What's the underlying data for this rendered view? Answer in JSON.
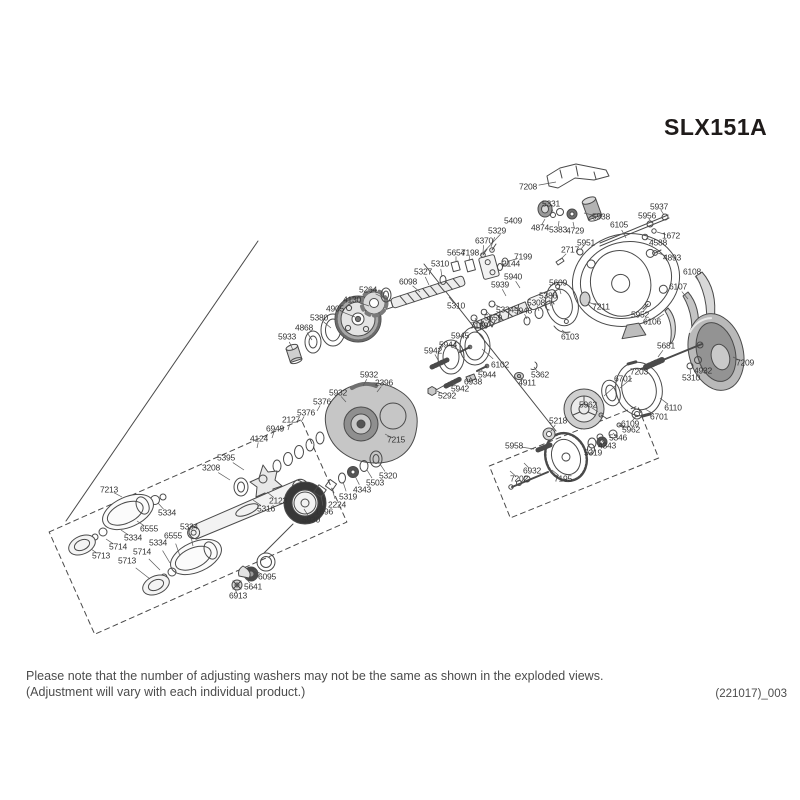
{
  "title": "SLX151A",
  "footer": {
    "line1": "Please note that the number of adjusting washers may not be the same as shown in the exploded views.",
    "line2": "(Adjustment will vary with each individual product.)"
  },
  "doc_code": "(221017)_003",
  "colors": {
    "line": "#4a4a4a",
    "label_text": "#333333",
    "title_text": "#1f1b1a",
    "footer_text": "#4c4c4c",
    "shade_light": "#d8d8d8",
    "shade_mid": "#a8a8a8",
    "shade_dark": "#383838"
  },
  "diagram": {
    "description": "Exploded parts view of SLX151A baitcasting reel",
    "labels": [
      {
        "n": "7208",
        "x": 528,
        "y": 187,
        "lx": 556,
        "ly": 182
      },
      {
        "n": "5331",
        "x": 551,
        "y": 204,
        "lx": 553,
        "ly": 212
      },
      {
        "n": "5938",
        "x": 601,
        "y": 217,
        "lx": 584,
        "ly": 213
      },
      {
        "n": "4874",
        "x": 540,
        "y": 228,
        "lx": 545,
        "ly": 219
      },
      {
        "n": "5383",
        "x": 558,
        "y": 230,
        "lx": 559,
        "ly": 221
      },
      {
        "n": "4729",
        "x": 575,
        "y": 231,
        "lx": 573,
        "ly": 222
      },
      {
        "n": "6105",
        "x": 619,
        "y": 225,
        "lx": 626,
        "ly": 238
      },
      {
        "n": "5956",
        "x": 647,
        "y": 216,
        "lx": 652,
        "ly": 223
      },
      {
        "n": "5937",
        "x": 659,
        "y": 207,
        "lx": 664,
        "ly": 215
      },
      {
        "n": "1672",
        "x": 671,
        "y": 236,
        "lx": 657,
        "ly": 232
      },
      {
        "n": "4588",
        "x": 658,
        "y": 243,
        "lx": 646,
        "ly": 238
      },
      {
        "n": "5409",
        "x": 513,
        "y": 221,
        "lx": 480,
        "ly": 256
      },
      {
        "n": "5329",
        "x": 497,
        "y": 231,
        "lx": 491,
        "ly": 247
      },
      {
        "n": "6370",
        "x": 484,
        "y": 241,
        "lx": 483,
        "ly": 252
      },
      {
        "n": "5654",
        "x": 456,
        "y": 253,
        "lx": 456,
        "ly": 262
      },
      {
        "n": "7198",
        "x": 470,
        "y": 253,
        "lx": 469,
        "ly": 261
      },
      {
        "n": "7199",
        "x": 523,
        "y": 257,
        "lx": 509,
        "ly": 261
      },
      {
        "n": "2144",
        "x": 511,
        "y": 264,
        "lx": 503,
        "ly": 264
      },
      {
        "n": "2717",
        "x": 570,
        "y": 250,
        "lx": 560,
        "ly": 260
      },
      {
        "n": "5951",
        "x": 586,
        "y": 243,
        "lx": 581,
        "ly": 249
      },
      {
        "n": "4893",
        "x": 672,
        "y": 258,
        "lx": 658,
        "ly": 253
      },
      {
        "n": "6108",
        "x": 692,
        "y": 272,
        "lx": 700,
        "ly": 283
      },
      {
        "n": "6107",
        "x": 678,
        "y": 287,
        "lx": 688,
        "ly": 299
      },
      {
        "n": "6106",
        "x": 652,
        "y": 322,
        "lx": 664,
        "ly": 314
      },
      {
        "n": "5310",
        "x": 440,
        "y": 264,
        "lx": 442,
        "ly": 277
      },
      {
        "n": "5327",
        "x": 423,
        "y": 272,
        "lx": 429,
        "ly": 285
      },
      {
        "n": "6098",
        "x": 408,
        "y": 282,
        "lx": 420,
        "ly": 292
      },
      {
        "n": "5264",
        "x": 368,
        "y": 290,
        "lx": 388,
        "ly": 300
      },
      {
        "n": "4130",
        "x": 352,
        "y": 300,
        "lx": 369,
        "ly": 306
      },
      {
        "n": "4905",
        "x": 335,
        "y": 309,
        "lx": 355,
        "ly": 317
      },
      {
        "n": "5380",
        "x": 319,
        "y": 318,
        "lx": 331,
        "ly": 328
      },
      {
        "n": "4868",
        "x": 304,
        "y": 328,
        "lx": 312,
        "ly": 340
      },
      {
        "n": "5933",
        "x": 287,
        "y": 337,
        "lx": 293,
        "ly": 350
      },
      {
        "n": "5940",
        "x": 513,
        "y": 277,
        "lx": 520,
        "ly": 288
      },
      {
        "n": "5939",
        "x": 500,
        "y": 285,
        "lx": 506,
        "ly": 296
      },
      {
        "n": "5609",
        "x": 558,
        "y": 283,
        "lx": 561,
        "ly": 294
      },
      {
        "n": "5310",
        "x": 456,
        "y": 306,
        "lx": 449,
        "ly": 297
      },
      {
        "n": "5334",
        "x": 505,
        "y": 310,
        "lx": 494,
        "ly": 304
      },
      {
        "n": "5386",
        "x": 548,
        "y": 296,
        "lx": 551,
        "ly": 306
      },
      {
        "n": "5308",
        "x": 536,
        "y": 303,
        "lx": 539,
        "ly": 311
      },
      {
        "n": "5948",
        "x": 523,
        "y": 311,
        "lx": 527,
        "ly": 319
      },
      {
        "n": "5659",
        "x": 493,
        "y": 318,
        "lx": 486,
        "ly": 311
      },
      {
        "n": "7199",
        "x": 479,
        "y": 326,
        "lx": 475,
        "ly": 318
      },
      {
        "n": "7211",
        "x": 601,
        "y": 307,
        "lx": 588,
        "ly": 302
      },
      {
        "n": "5952",
        "x": 640,
        "y": 315,
        "lx": 648,
        "ly": 306
      },
      {
        "n": "6103",
        "x": 570,
        "y": 337,
        "lx": 562,
        "ly": 330
      },
      {
        "n": "5945",
        "x": 460,
        "y": 336,
        "lx": 452,
        "ly": 348
      },
      {
        "n": "5681",
        "x": 666,
        "y": 346,
        "lx": 658,
        "ly": 357
      },
      {
        "n": "7203",
        "x": 639,
        "y": 372,
        "lx": 620,
        "ly": 388
      },
      {
        "n": "6701",
        "x": 623,
        "y": 379,
        "lx": 604,
        "ly": 396
      },
      {
        "n": "4932",
        "x": 703,
        "y": 371,
        "lx": 699,
        "ly": 362
      },
      {
        "n": "5310",
        "x": 691,
        "y": 378,
        "lx": 690,
        "ly": 368
      },
      {
        "n": "7209",
        "x": 745,
        "y": 363,
        "lx": 733,
        "ly": 357
      },
      {
        "n": "6110",
        "x": 673,
        "y": 408,
        "lx": 660,
        "ly": 398
      },
      {
        "n": "6701",
        "x": 659,
        "y": 417,
        "lx": 645,
        "ly": 409
      },
      {
        "n": "5962",
        "x": 588,
        "y": 405,
        "lx": 598,
        "ly": 412
      },
      {
        "n": "6109",
        "x": 630,
        "y": 424,
        "lx": 636,
        "ly": 416
      },
      {
        "n": "5962",
        "x": 631,
        "y": 430,
        "lx": 621,
        "ly": 425
      },
      {
        "n": "5346",
        "x": 618,
        "y": 438,
        "lx": 613,
        "ly": 433
      },
      {
        "n": "4343",
        "x": 607,
        "y": 446,
        "lx": 602,
        "ly": 441
      },
      {
        "n": "5319",
        "x": 593,
        "y": 453,
        "lx": 591,
        "ly": 448
      },
      {
        "n": "5218",
        "x": 558,
        "y": 421,
        "lx": 551,
        "ly": 431
      },
      {
        "n": "5958",
        "x": 514,
        "y": 446,
        "lx": 534,
        "ly": 449
      },
      {
        "n": "6932",
        "x": 532,
        "y": 471,
        "lx": 524,
        "ly": 463
      },
      {
        "n": "7202",
        "x": 519,
        "y": 479,
        "lx": 510,
        "ly": 471
      },
      {
        "n": "7195",
        "x": 563,
        "y": 479,
        "lx": 552,
        "ly": 470
      },
      {
        "n": "5362",
        "x": 540,
        "y": 375,
        "lx": 534,
        "ly": 367
      },
      {
        "n": "4911",
        "x": 527,
        "y": 383,
        "lx": 520,
        "ly": 377
      },
      {
        "n": "6102",
        "x": 500,
        "y": 365,
        "lx": 482,
        "ly": 349
      },
      {
        "n": "5944",
        "x": 448,
        "y": 345,
        "lx": 461,
        "ly": 351
      },
      {
        "n": "5942",
        "x": 433,
        "y": 351,
        "lx": 438,
        "ly": 360
      },
      {
        "n": "5944",
        "x": 487,
        "y": 375,
        "lx": 480,
        "ly": 369
      },
      {
        "n": "6938",
        "x": 473,
        "y": 382,
        "lx": 469,
        "ly": 375
      },
      {
        "n": "5942",
        "x": 460,
        "y": 389,
        "lx": 453,
        "ly": 383
      },
      {
        "n": "5292",
        "x": 447,
        "y": 396,
        "lx": 437,
        "ly": 391
      },
      {
        "n": "5932",
        "x": 369,
        "y": 375,
        "lx": 363,
        "ly": 386
      },
      {
        "n": "2396",
        "x": 384,
        "y": 383,
        "lx": 377,
        "ly": 392
      },
      {
        "n": "5932",
        "x": 338,
        "y": 393,
        "lx": 346,
        "ly": 402
      },
      {
        "n": "5376",
        "x": 322,
        "y": 402,
        "lx": 317,
        "ly": 411
      },
      {
        "n": "5376",
        "x": 306,
        "y": 413,
        "lx": 301,
        "ly": 422
      },
      {
        "n": "2127",
        "x": 291,
        "y": 420,
        "lx": 288,
        "ly": 430
      },
      {
        "n": "6949",
        "x": 275,
        "y": 429,
        "lx": 272,
        "ly": 438
      },
      {
        "n": "4124",
        "x": 259,
        "y": 439,
        "lx": 257,
        "ly": 448
      },
      {
        "n": "7215",
        "x": 396,
        "y": 440,
        "lx": 385,
        "ly": 434
      },
      {
        "n": "5395",
        "x": 226,
        "y": 458,
        "lx": 244,
        "ly": 470
      },
      {
        "n": "3208",
        "x": 211,
        "y": 468,
        "lx": 230,
        "ly": 480
      },
      {
        "n": "2123",
        "x": 278,
        "y": 501,
        "lx": 267,
        "ly": 492
      },
      {
        "n": "5316",
        "x": 266,
        "y": 509,
        "lx": 253,
        "ly": 500
      },
      {
        "n": "5320",
        "x": 388,
        "y": 476,
        "lx": 380,
        "ly": 464
      },
      {
        "n": "5503",
        "x": 375,
        "y": 483,
        "lx": 367,
        "ly": 470
      },
      {
        "n": "4343",
        "x": 362,
        "y": 490,
        "lx": 355,
        "ly": 476
      },
      {
        "n": "5319",
        "x": 348,
        "y": 497,
        "lx": 343,
        "ly": 482
      },
      {
        "n": "2224",
        "x": 337,
        "y": 505,
        "lx": 332,
        "ly": 489
      },
      {
        "n": "1696",
        "x": 324,
        "y": 512,
        "lx": 321,
        "ly": 495
      },
      {
        "n": "5930",
        "x": 311,
        "y": 520,
        "lx": 304,
        "ly": 509
      },
      {
        "n": "7213",
        "x": 109,
        "y": 490,
        "lx": 122,
        "ly": 497
      },
      {
        "n": "5334",
        "x": 167,
        "y": 513,
        "lx": 158,
        "ly": 503
      },
      {
        "n": "6555",
        "x": 149,
        "y": 529,
        "lx": 137,
        "ly": 521
      },
      {
        "n": "5334",
        "x": 133,
        "y": 538,
        "lx": 121,
        "ly": 530
      },
      {
        "n": "5714",
        "x": 118,
        "y": 547,
        "lx": 106,
        "ly": 539
      },
      {
        "n": "5713",
        "x": 101,
        "y": 556,
        "lx": 91,
        "ly": 549
      },
      {
        "n": "5334",
        "x": 189,
        "y": 527,
        "lx": 193,
        "ly": 546
      },
      {
        "n": "6555",
        "x": 173,
        "y": 536,
        "lx": 180,
        "ly": 556
      },
      {
        "n": "5334",
        "x": 158,
        "y": 543,
        "lx": 170,
        "ly": 563
      },
      {
        "n": "5714",
        "x": 142,
        "y": 552,
        "lx": 160,
        "ly": 570
      },
      {
        "n": "5713",
        "x": 127,
        "y": 561,
        "lx": 150,
        "ly": 579
      },
      {
        "n": "6095",
        "x": 267,
        "y": 577,
        "lx": 254,
        "ly": 570
      },
      {
        "n": "5641",
        "x": 253,
        "y": 587,
        "lx": 245,
        "ly": 577
      },
      {
        "n": "6913",
        "x": 238,
        "y": 596,
        "lx": 235,
        "ly": 589
      }
    ]
  }
}
